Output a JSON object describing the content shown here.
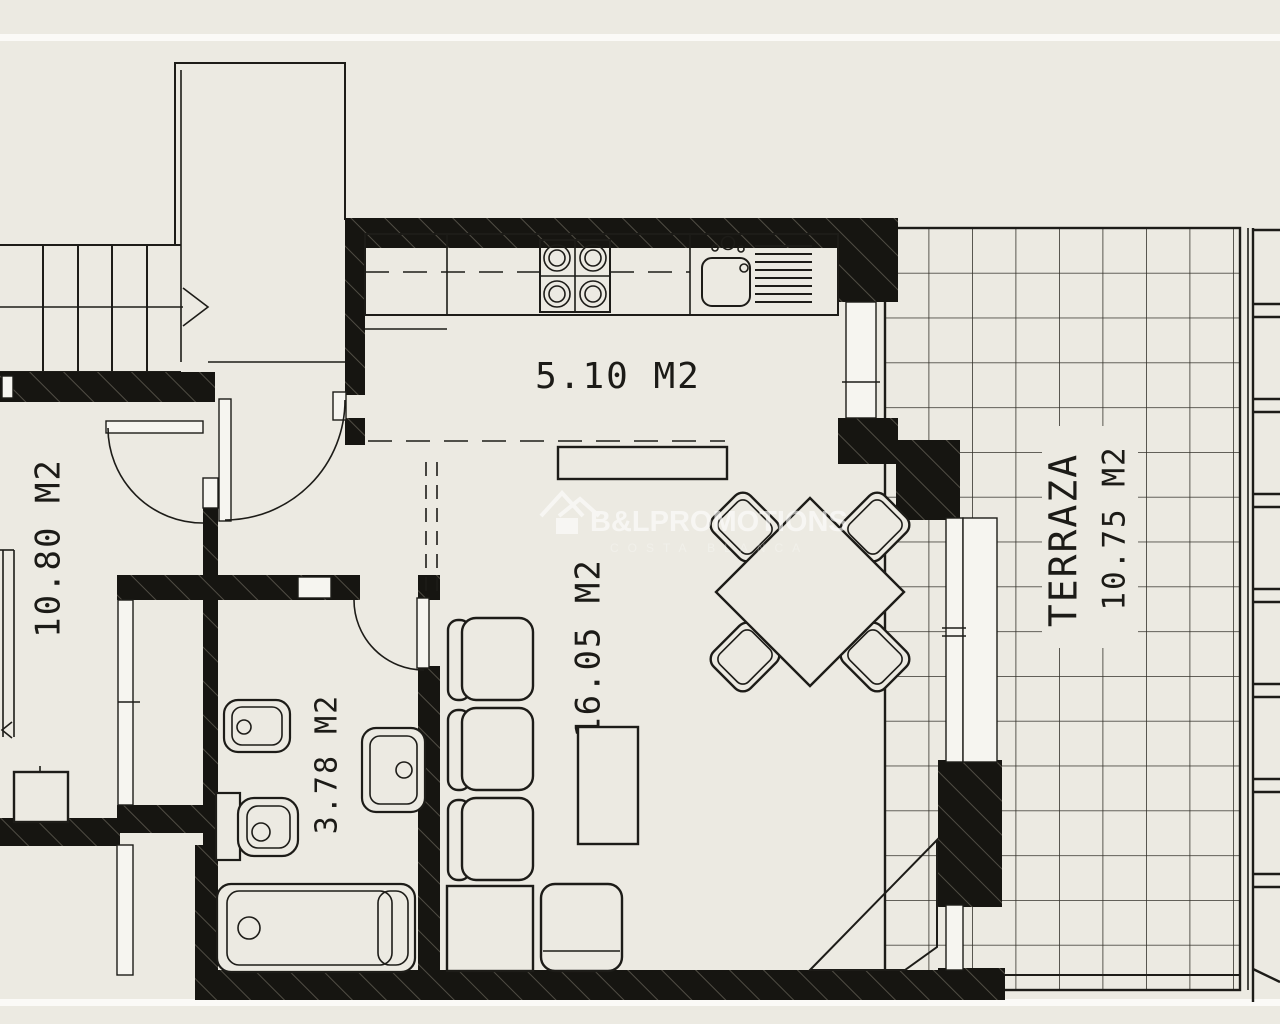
{
  "watermark": {
    "brand": "B&LPROMOTIONS",
    "subtitle": "COSTA BLANCA",
    "logo": "house-logo-icon"
  },
  "rooms": {
    "kitchen": {
      "area_label": "5.10 M2"
    },
    "living": {
      "area_label": "16.05 M2"
    },
    "bedroom": {
      "area_label": "10.80 M2"
    },
    "bathroom": {
      "area_label": "3.78 M2"
    },
    "terrace": {
      "name": "TERRAZA",
      "area_label": "10.75 M2"
    }
  },
  "colors": {
    "background": "#eceae2",
    "line": "#1d1c18",
    "wall": "#161511",
    "watermark": "#ffffff"
  }
}
